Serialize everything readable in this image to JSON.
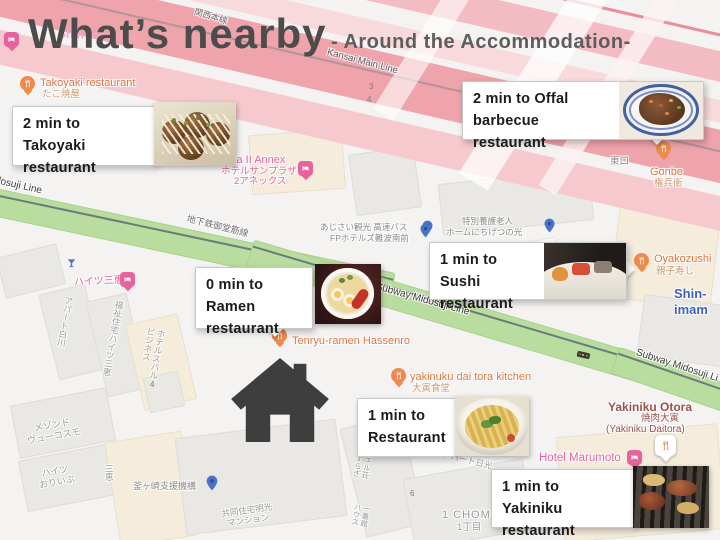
{
  "title": {
    "main": "What’s nearby",
    "subtitle": "- Around the Accommodation-",
    "ghost_label": "Shin-Imamiya"
  },
  "callouts": [
    {
      "line1": "2 min to",
      "line2": "Takoyaki restaurant"
    },
    {
      "line1": "2 min to Offal",
      "line2": "barbecue restaurant"
    },
    {
      "line1": "1 min to",
      "line2": "Sushi restaurant"
    },
    {
      "line1": "0 min to",
      "line2": "Ramen restaurant"
    },
    {
      "line1": "1 min to",
      "line2": "Restaurant"
    },
    {
      "line1": "1 min to",
      "line2": "Yakiniku restaurant"
    }
  ],
  "pois": {
    "takoyaki": {
      "name": "Takoyaki restaurant",
      "sub": "たこ焼屋"
    },
    "sunplaza": {
      "name": "Hotel Sunplaza II Annex",
      "sub1": "ホテルサンプラザ",
      "sub2": "2アネックス"
    },
    "gonbe": {
      "name": "Gonbe",
      "sub": "権兵衛"
    },
    "oyakozushi": {
      "name": "Oyakozushi",
      "sub": "親子寿し"
    },
    "tenryu": {
      "name": "Tenryu-ramen Hassenro"
    },
    "daitora_kitchen": {
      "name": "yakinuku dai tora kitchen",
      "sub": "大寅食堂"
    },
    "otora": {
      "name": "Yakiniku Otora",
      "sub1": "焼肉大寅",
      "sub2": "(Yakiniku Daitora)"
    },
    "marumoto": {
      "name": "Hotel Marumoto"
    },
    "haitsu_sankei": {
      "name": "ハイツ三恵"
    },
    "care_home": {
      "line1": "特別養護老人",
      "line2": "ホームにちげつの光"
    },
    "ajisai": {
      "line1": "あじさい観光 高速バス",
      "line2": "FPホテルズ難波南前"
    },
    "kamagasaki": {
      "name": "釜ヶ崎支援機構"
    }
  },
  "roads": {
    "kansai": "Kansai Main Line",
    "kansai_jp": "関西本線",
    "midosuji": "Midosuji Line",
    "midosuji_jp": "地下鉄御堂筋線",
    "subway_center": "Subway Midosuji Line",
    "subway_right": "Subway Midosuji Li",
    "east_exit": "東口",
    "station": "Shin-imam"
  },
  "buildings": {
    "apart_shirakawa": "アパート白川",
    "fukushi": "福祉住宅ハイツ三恵",
    "business_hotel": "ビジネス\nホテルスバル",
    "sankei_v": "三恵",
    "maison": "メゾンド\nヴューコスモ",
    "olive": "ハイツ\nおりいぶ",
    "kyodo": "共同住宅明光\nマンション",
    "apart_nikko": "アパート日光",
    "yasuragi": "やすらぎ\nヴェル荘",
    "ichiban": "ハウス\n一番館"
  },
  "numbers": {
    "n3": "3",
    "n4a": "4",
    "n4b": "4",
    "n6": "6",
    "chome_en": "1 CHOME",
    "chome_jp": "1丁目"
  },
  "colors": {
    "rail_pink": "#efa3ab",
    "road_green": "#b9dd9f",
    "poi_orange": "#ee8a4c",
    "label_orange": "#e2743f",
    "hotel_pink": "#e7639e",
    "pin_blue": "#4a72c7",
    "station_blue": "#3e5fc1",
    "title_gray": "#4c4c4c",
    "otora_brown": "#9a5148",
    "house_gray": "#3e3e3e"
  }
}
